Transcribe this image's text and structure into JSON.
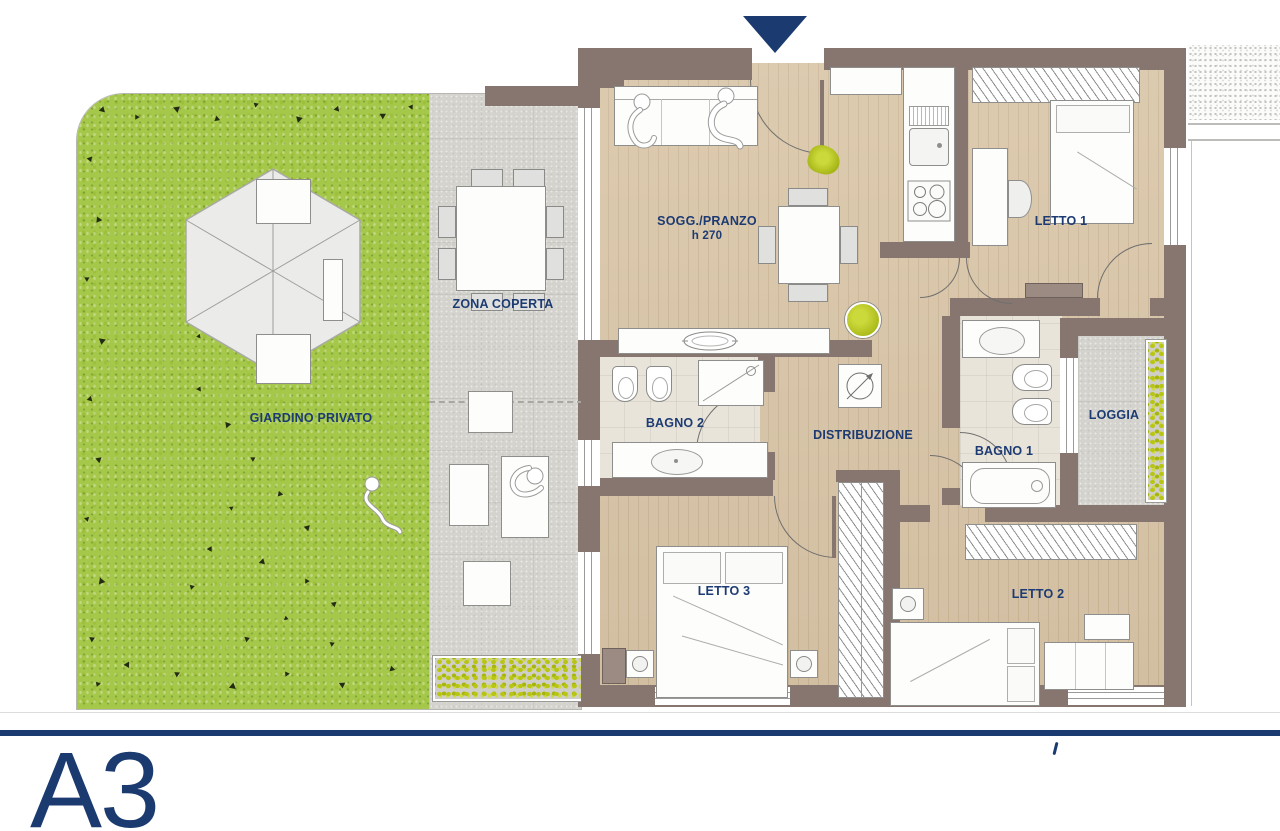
{
  "unit_label": "A3",
  "rooms": {
    "soggiorno": {
      "label": "SOGG./PRANZO",
      "height_note": "h 270"
    },
    "letto1": {
      "label": "LETTO 1"
    },
    "bagno2": {
      "label": "BAGNO 2"
    },
    "distribuzione": {
      "label": "DISTRIBUZIONE"
    },
    "bagno1": {
      "label": "BAGNO 1"
    },
    "loggia": {
      "label": "LOGGIA"
    },
    "letto3": {
      "label": "LETTO 3"
    },
    "letto2": {
      "label": "LETTO 2"
    }
  },
  "outdoor": {
    "giardino": {
      "label": "GIARDINO PRIVATO"
    },
    "zona_coperta": {
      "label": "ZONA COPERTA"
    }
  },
  "icons": {
    "entrance_marker": "down-triangle"
  },
  "colors": {
    "accent": "#1b3a70",
    "wall": "#877670",
    "grass": "#a6c84a",
    "plant": "#b9c513",
    "wood": "#d9c5a7"
  }
}
